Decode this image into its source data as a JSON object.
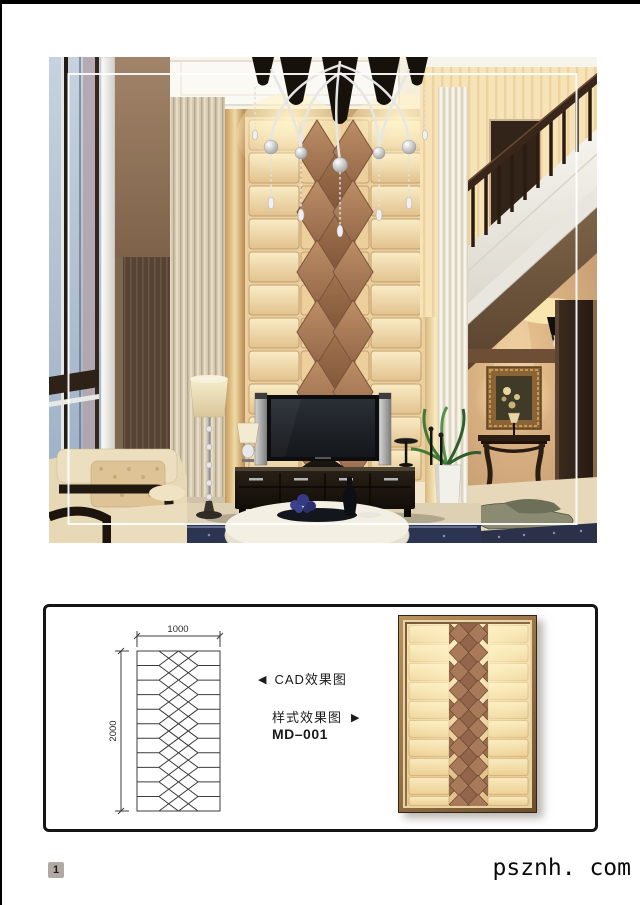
{
  "page": {
    "number": "1",
    "watermark": "psznh. com"
  },
  "drawing": {
    "dim_width": "1000",
    "dim_height": "2000",
    "cad_arrow": "◀",
    "cad_label": "CAD效果图",
    "style_label": "样式效果图",
    "style_arrow": "▶",
    "model_code": "MD–001"
  },
  "colors": {
    "panel_border": "#151515",
    "bronze_diamond": "#a87b58",
    "cream_tile": "#f6e7bd",
    "frame_gold": "#9c7848"
  }
}
